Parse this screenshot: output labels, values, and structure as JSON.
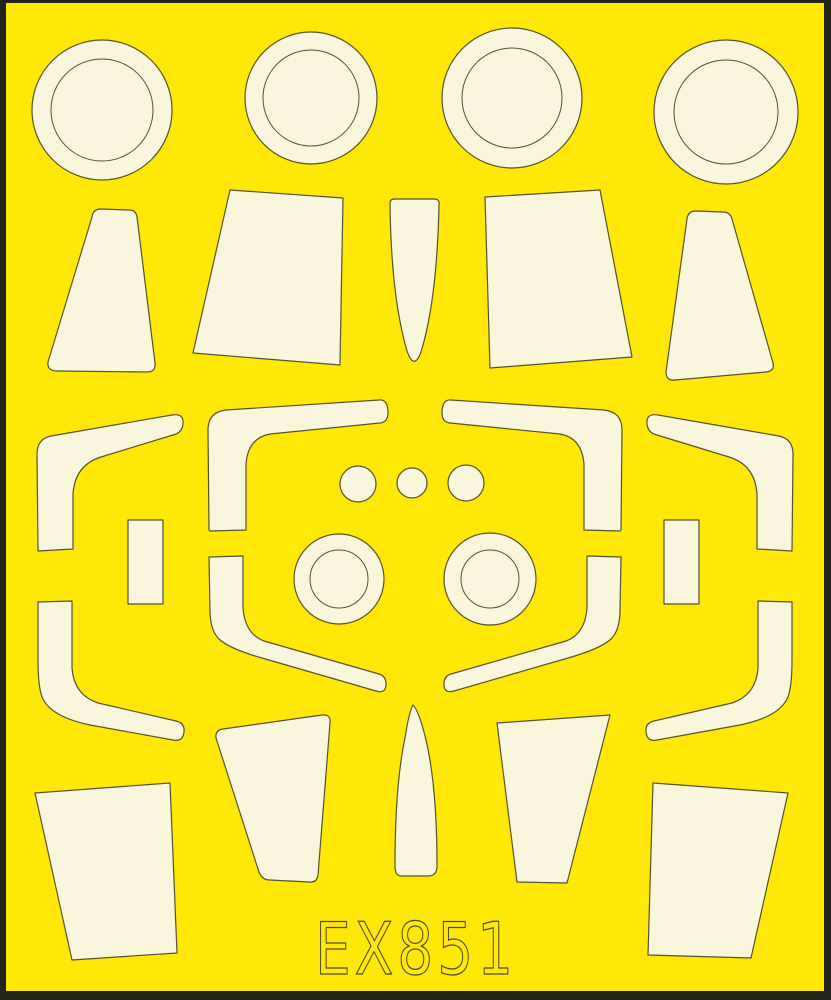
{
  "product_code": "EX851",
  "sheet": {
    "kind": "die-cut masking sheet",
    "orientation": "portrait"
  },
  "colors": {
    "background": "#ffe707",
    "mask": "#faf6de",
    "outline": "#57522f",
    "frame": "#23231a",
    "text_outline": "#4b4b32"
  },
  "mask_inventory": {
    "round_ring_masks": 4,
    "small_dot_masks": 3,
    "bullseye_masks": 2,
    "rectangle_masks": 2,
    "trapezoid_panel_masks": 8,
    "petal_blade_masks": 2,
    "canopy_frame_band_masks": 8
  }
}
